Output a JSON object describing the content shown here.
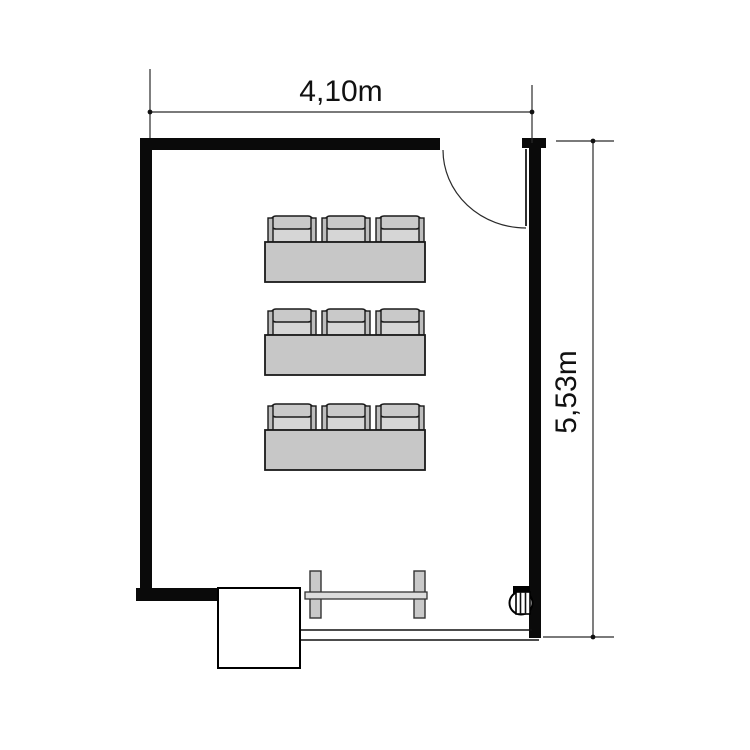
{
  "page": {
    "type": "floor-plan"
  },
  "dimensions": {
    "width": {
      "label": "4,10m"
    },
    "height": {
      "label": "5,53m"
    }
  },
  "room": {
    "desk_rows": 3,
    "seats_per_row": 3,
    "total_chairs": 9,
    "furniture_visible": [
      "student-desk-row",
      "chairs",
      "teacher-table",
      "cabinet",
      "door",
      "round-wall-fixture"
    ]
  },
  "colors": {
    "wall": "#0a0a0a",
    "furniture_fill": "#c7c7c7",
    "seat_fill": "#d6d6d6",
    "background": "#ffffff"
  }
}
